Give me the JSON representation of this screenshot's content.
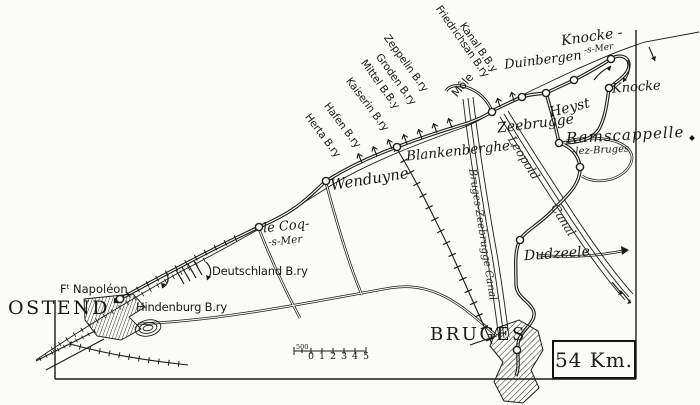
{
  "map": {
    "cities": {
      "ostend": "OSTEND",
      "bruges": "BRUGES"
    },
    "towns": {
      "le_coq_line1": "le Coq-",
      "le_coq_line2": "-s-Mer",
      "wenduyne": "Wenduyne",
      "blankenberghe": "Blankenberghe-",
      "zeebrugge": "Zeebrugge",
      "heyst": "Heyst",
      "duinbergen": "Duinbergen",
      "knocke_s_mer_line1": "Knocke -",
      "knocke_s_mer_line2": "-s-Mer",
      "knocke": "Knocke",
      "ramscappelle_line1": "Ramscappelle",
      "ramscappelle_line2": "-lez-Bruges",
      "dudzeele": "Dudzeele"
    },
    "forts": {
      "ft_napoleon_prefix": "F",
      "ft_napoleon_sup": "t",
      "ft_napoleon_name": "Napoléon",
      "hindenburg": "Hindenburg B.ry",
      "deutschland": "Deutschland B.ry"
    },
    "batteries": {
      "herta": "Herta B.ry",
      "hafen": "Hafen B.ry",
      "kaiserin": "Kaiserin B.ry",
      "mittel": "Mittel B.B.y",
      "groden": "Groden B.ry",
      "zeppelin": "Zeppelin B.ry",
      "friedrichsan": "Friedrichsan B.ry",
      "kanal": "Kanal B.B.y"
    },
    "features": {
      "mole": "Môle"
    },
    "canals": {
      "bruges_zeebrugge": "Bruges-Zeebrugge Canal",
      "leopold_word1": "Leopold",
      "leopold_word2": "Canal"
    },
    "distance_box": "54 Km.",
    "scale": {
      "five_hundred": "500",
      "t0": "0",
      "t1": "1",
      "t2": "2",
      "t3": "3",
      "t4": "4",
      "t5": "5"
    },
    "ink_color": "#1b1b1b",
    "paper_color": "#fbfbf8"
  }
}
